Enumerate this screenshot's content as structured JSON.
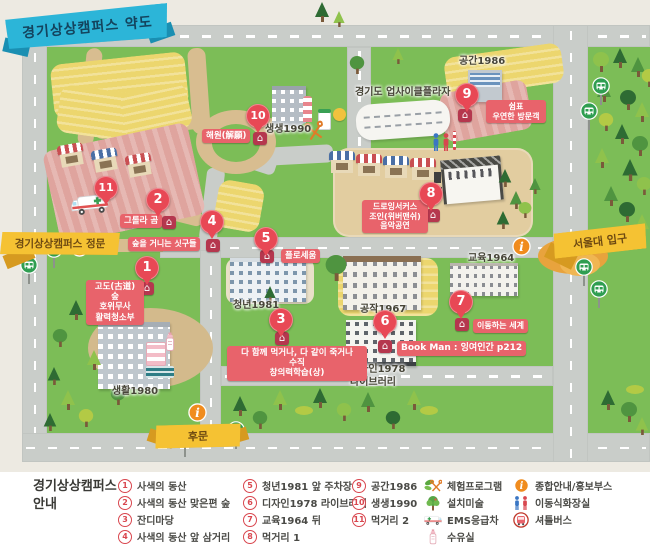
{
  "title": "경기상상캠퍼스 약도",
  "gates": {
    "main": "경기상상캠퍼스 정문",
    "seoul_univ": "서울대 입구",
    "back": "후문"
  },
  "buildings": {
    "saenghwal": "생활1980",
    "cheongnyeon": "청년1981",
    "gongjak": "공작1967",
    "design": "디자인1978\n라이브러리",
    "gyoyuk": "교육1964",
    "gonggan": "공간1986",
    "saengsaeng": "생생1990",
    "upcycle": "경기도 업사이클플라자"
  },
  "markers": {
    "m1": {
      "num": "1",
      "label": "고도(古道)\n숲\n호위무사\n활력청소부"
    },
    "m2": {
      "num": "2",
      "label": "그롤라 곰"
    },
    "m3": {
      "num": "3",
      "label": "다 함께 먹거나, 다 같이 죽거나\n수직\n창의력학습(상)"
    },
    "m4": {
      "num": "4",
      "label": "숲을 거니는 싯구들"
    },
    "m5": {
      "num": "5",
      "label": "플로세움"
    },
    "m6": {
      "num": "6",
      "label": "Book Man : 잉여인간 p212"
    },
    "m7": {
      "num": "7",
      "label": "이동하는 세계"
    },
    "m8": {
      "num": "8",
      "label": "드로잉서커스\n조인(위버맨쉬)\n음악공연"
    },
    "m9": {
      "num": "9",
      "label": "쉼표\n우연한 방문객"
    },
    "m10": {
      "num": "10",
      "label": "해원(解願)"
    },
    "m11": {
      "num": "11",
      "label": ""
    }
  },
  "icons": {
    "house": "⌂",
    "info": "i"
  },
  "colors": {
    "grass": "#7cbd57",
    "road": "#c9cdc9",
    "path": "#d8bd90",
    "field": "#ecd66e",
    "market": "#dfa49e",
    "marker_red": "#e84855",
    "chip_pink": "#e8636b",
    "ribbon_blue": "#2cb5d8",
    "ribbon_yellow": "#f5c233"
  },
  "legend": {
    "title": "경기상상캠퍼스\n안내",
    "items": [
      {
        "num": "1",
        "label": "사색의 동산"
      },
      {
        "num": "2",
        "label": "사색의 동산 맞은편 숲"
      },
      {
        "num": "3",
        "label": "잔디마당"
      },
      {
        "num": "4",
        "label": "사색의 동산 앞 삼거리"
      },
      {
        "num": "5",
        "label": "청년1981 앞 주차장"
      },
      {
        "num": "6",
        "label": "디자인1978 라이브러리"
      },
      {
        "num": "7",
        "label": "교육1964 뒤"
      },
      {
        "num": "8",
        "label": "먹거리 1"
      },
      {
        "num": "9",
        "label": "공간1986"
      },
      {
        "num": "10",
        "label": "생생1990"
      },
      {
        "num": "11",
        "label": "먹거리 2"
      }
    ],
    "icons": [
      {
        "icon": "experience-program-icon",
        "label": "체험프로그램"
      },
      {
        "icon": "installation-art-icon",
        "label": "설치미술"
      },
      {
        "icon": "ems-ambulance-icon",
        "label": "EMS응급차"
      },
      {
        "icon": "nursing-room-icon",
        "label": "수유실"
      },
      {
        "icon": "info-booth-icon",
        "label": "종합안내/홍보부스"
      },
      {
        "icon": "portable-toilet-icon",
        "label": "이동식화장실"
      },
      {
        "icon": "shuttle-bus-icon",
        "label": "셔틀버스"
      }
    ]
  }
}
